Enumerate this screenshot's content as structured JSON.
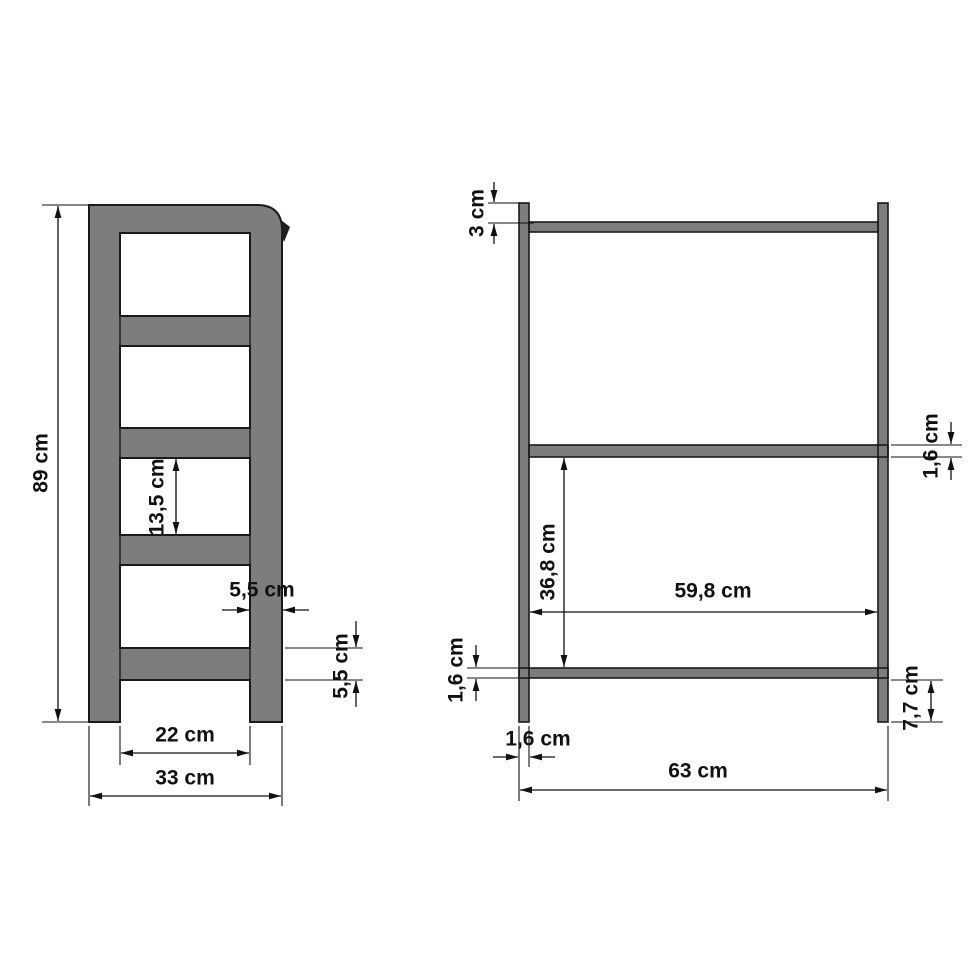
{
  "page": {
    "background": "#ffffff",
    "description": "Technical dimension drawing of a ladder shelf, side view and front view"
  },
  "diagram": {
    "colors": {
      "material_fill": "#7d7d7d",
      "outline": "#1a1a1a",
      "dimension_ink": "#111111"
    },
    "views": {
      "side_view": {
        "labels": {
          "overall_height": "89 cm",
          "opening_height": "13,5 cm",
          "rail_depth": "5,5 cm",
          "bottom_rail_thickness": "5,5 cm",
          "leg_inner_span": "22 cm",
          "overall_depth": "33 cm"
        }
      },
      "front_view": {
        "labels": {
          "top_overhang": "3 cm",
          "middle_shelf_thickness": "1,6 cm",
          "shelf_clear_height": "36,8 cm",
          "inner_width": "59,8 cm",
          "bottom_shelf_thickness": "1,6 cm",
          "post_thickness": "1,6 cm",
          "foot_height": "7,7 cm",
          "overall_width": "63 cm"
        }
      }
    }
  }
}
